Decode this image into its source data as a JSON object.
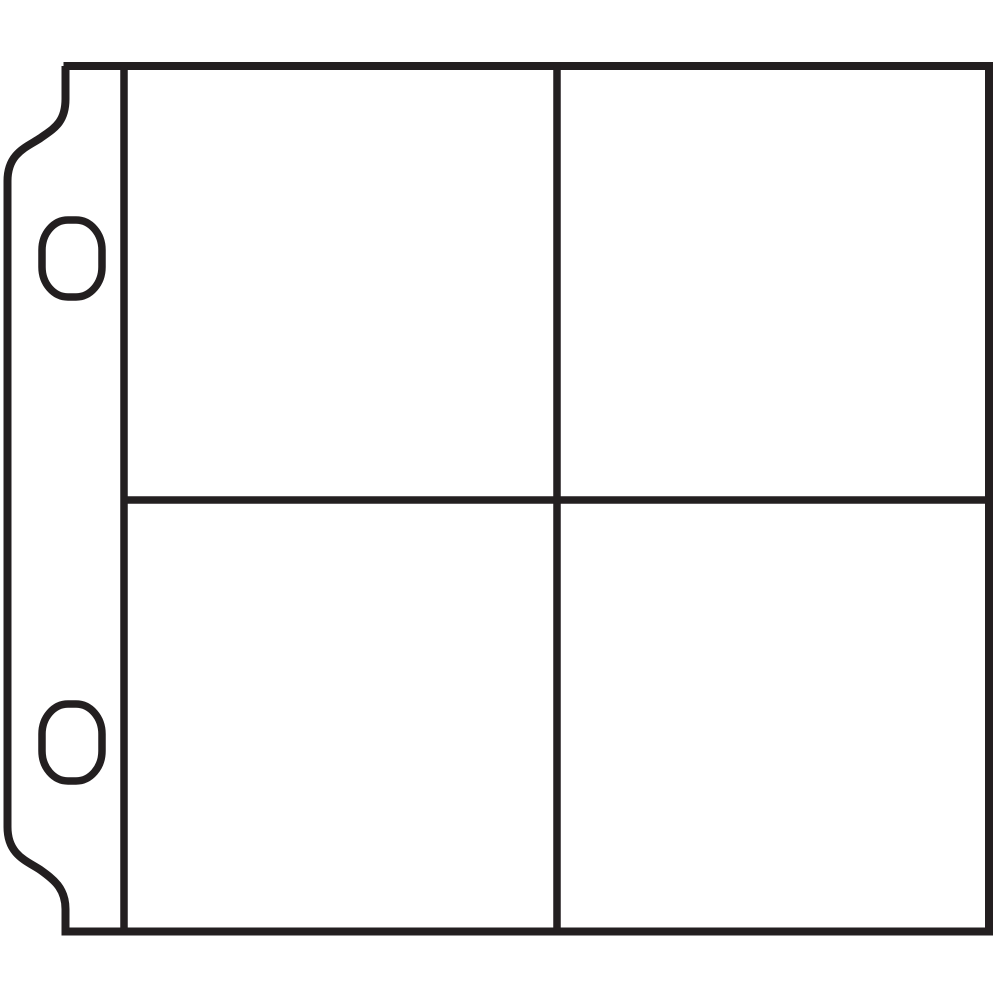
{
  "figure": {
    "name": "four-pocket-page-protector",
    "description": "Black line drawing of a ring-binder page protector sheet with a punched binding strip on the left (two oval holes, scalloped top and bottom tabs) and four photo pockets arranged in a 2x2 grid",
    "background_color": "#ffffff",
    "line_color": "#231f20",
    "pocket_rows": 2,
    "pocket_columns": 2,
    "binding_hole_count": 2,
    "text_labels": []
  }
}
